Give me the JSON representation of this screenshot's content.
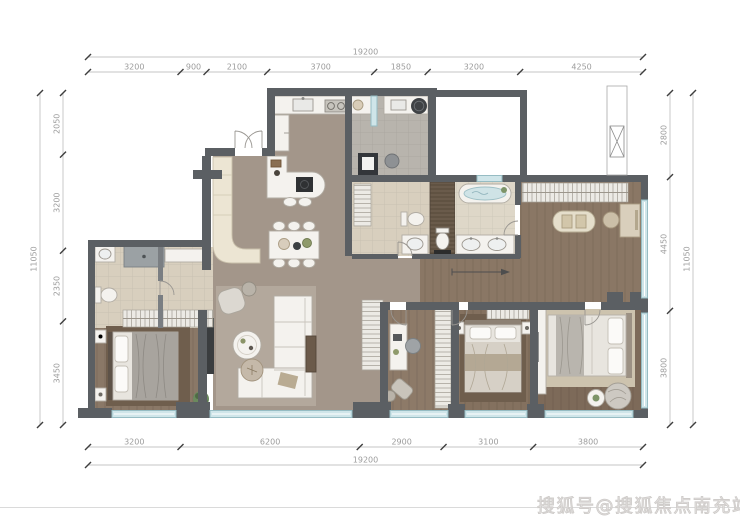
{
  "page": {
    "watermark": "搜狐号@搜狐焦点南充站"
  },
  "floorplan": {
    "dimensions": {
      "top": {
        "total": "19200",
        "segments": [
          "3200",
          "900",
          "2100",
          "3700",
          "1850",
          "3200",
          "4250"
        ]
      },
      "bottom": {
        "total": "19200",
        "segments": [
          "3200",
          "6200",
          "2900",
          "3100",
          "3800"
        ]
      },
      "left": {
        "total": "11050",
        "segments": [
          "2050",
          "3200",
          "2350",
          "3450"
        ]
      },
      "right": {
        "total": "11050",
        "segments": [
          "2800",
          "4450",
          "3800"
        ]
      }
    },
    "colors": {
      "wall": "#5b5f63",
      "floor_main": "#a3968a",
      "floor_wood": "#8a7765",
      "floor_wood_dark": "#7d6a59",
      "tile_gray": "#b8b4ad",
      "tile_beige": "#d8cfbe",
      "tile_bath": "#ded7c8",
      "window_glass": "#cfe5e9",
      "window_frame": "#96bcc3",
      "furniture_white": "#f4f2ee",
      "furniture_stroke": "#b1aca3",
      "accent_dark": "#383b3e",
      "dim_line": "#b3b3b3",
      "dim_text": "#9c9c9c",
      "watermark_gray": "#cfccca"
    }
  }
}
